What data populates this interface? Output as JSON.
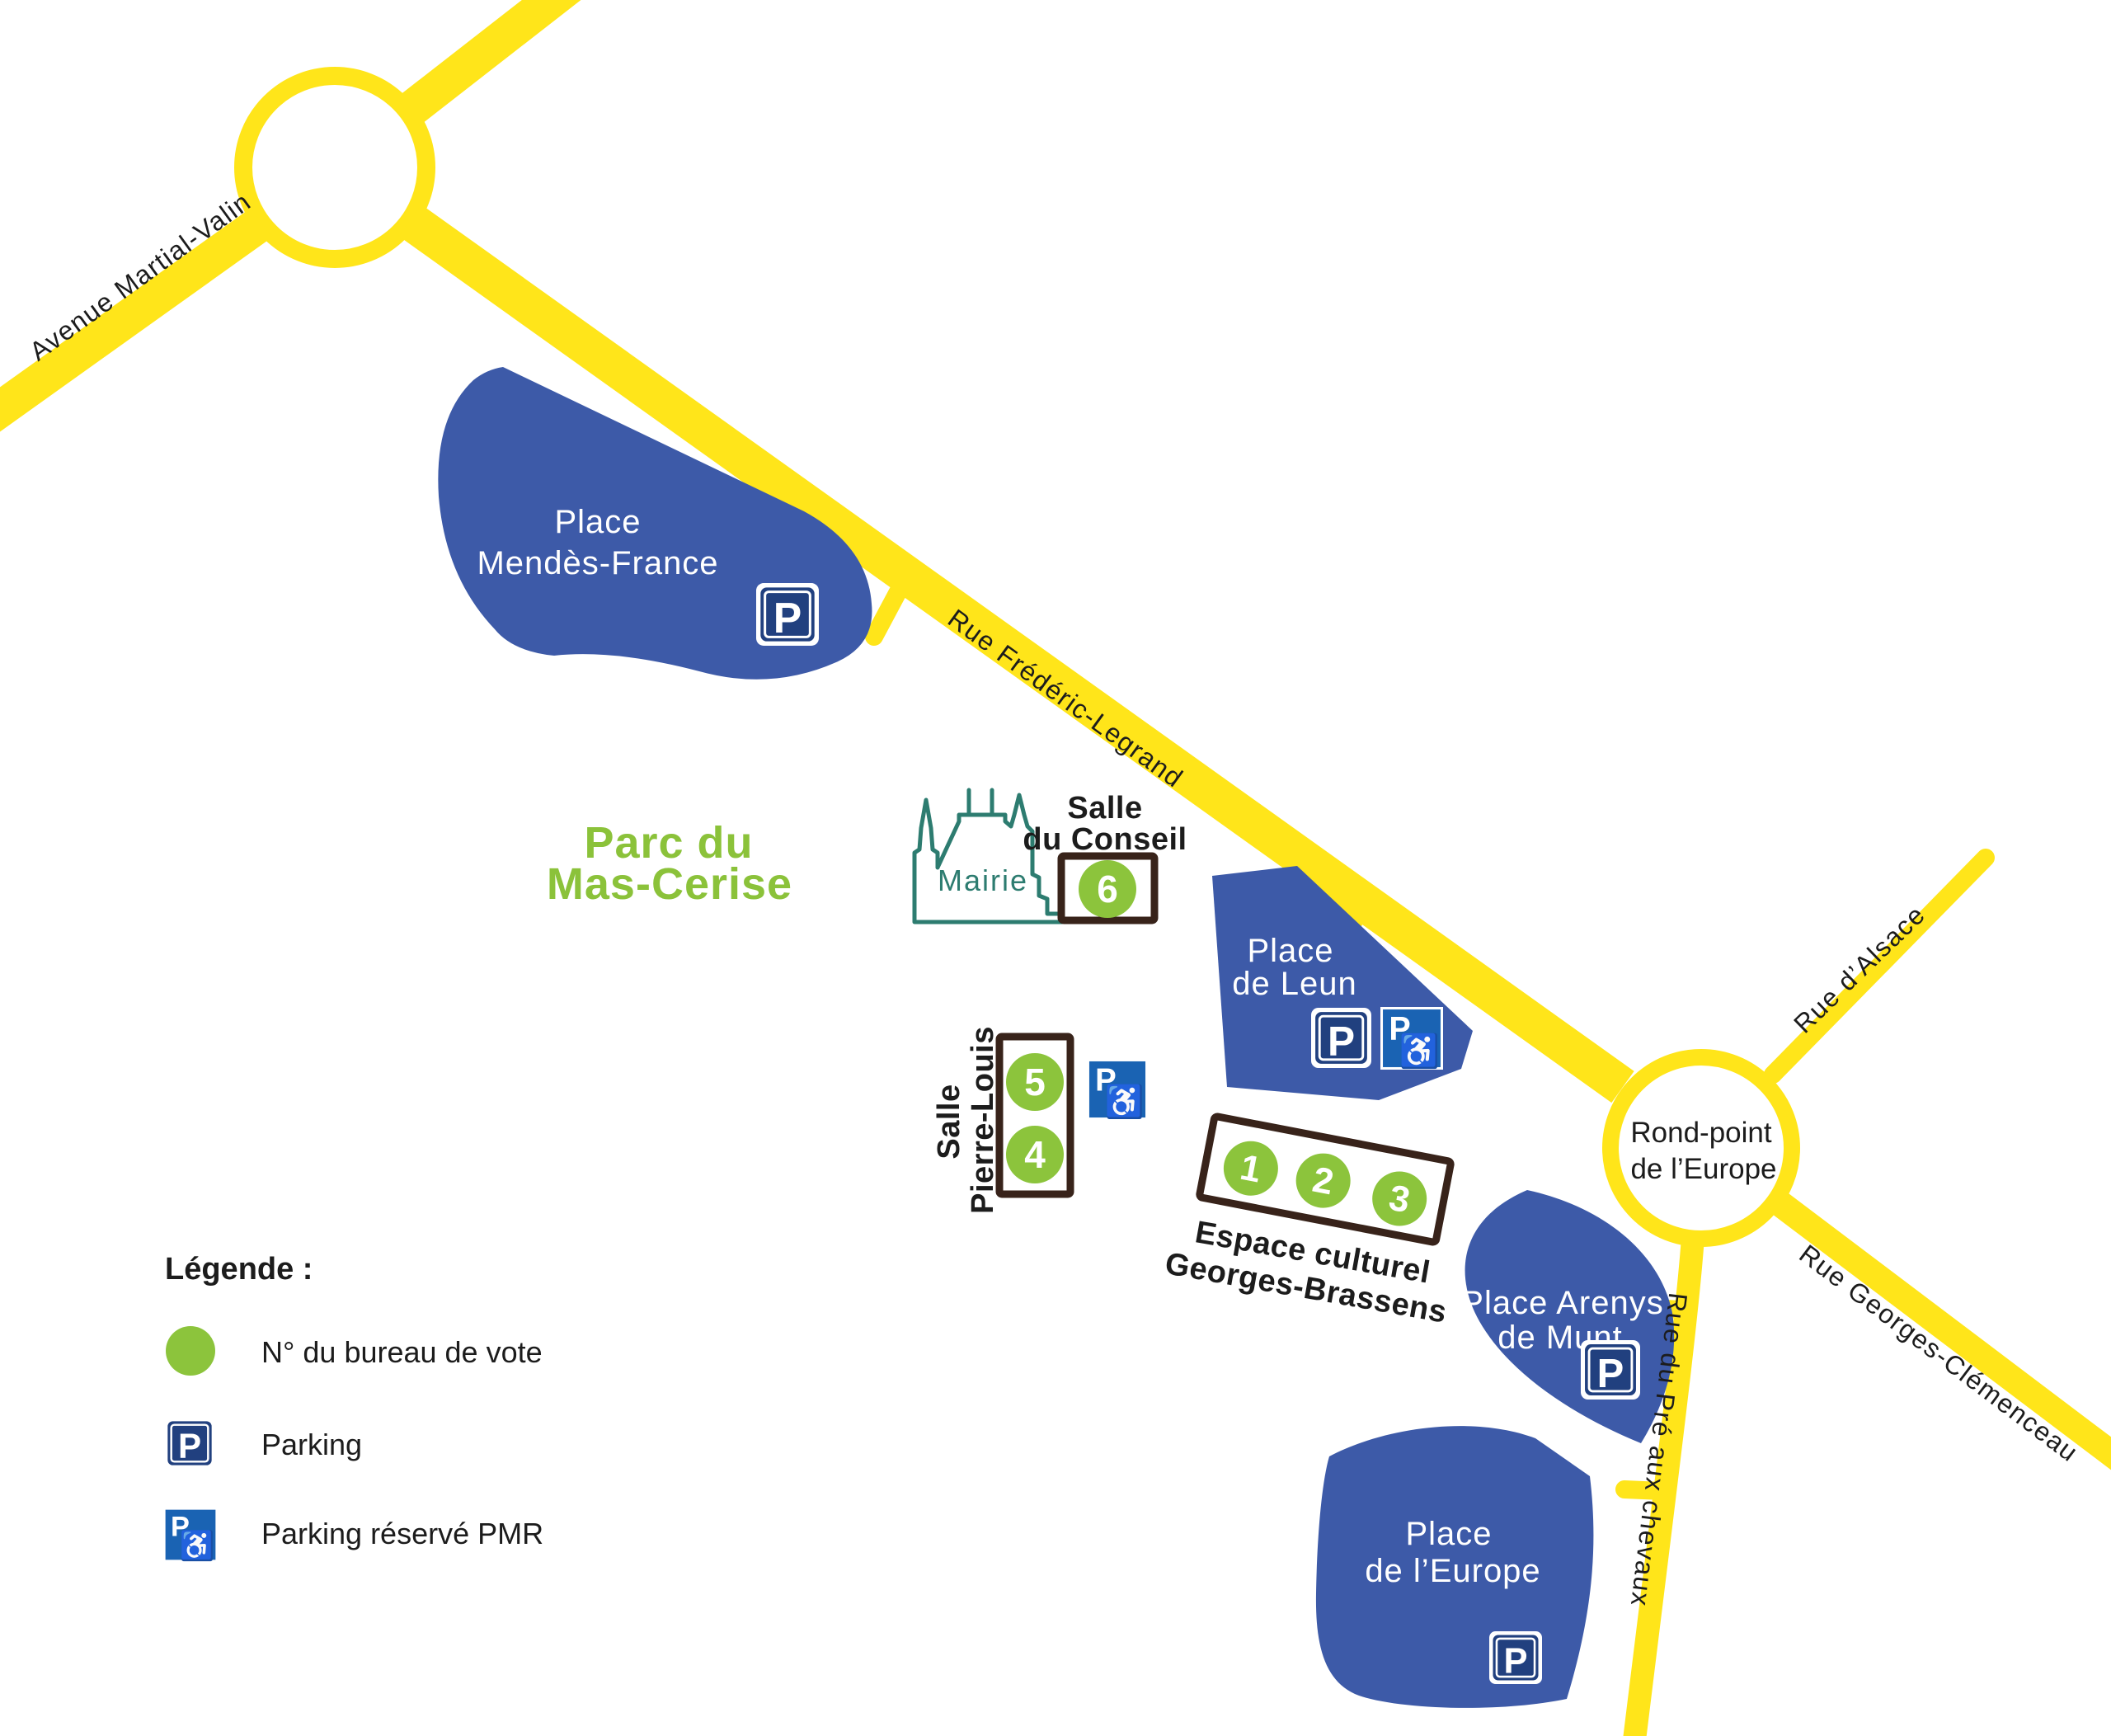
{
  "colors": {
    "road": "#ffe51a",
    "place": "#3d5aa8",
    "place_text": "#ffffff",
    "bureau": "#8cc43c",
    "parc_green": "#8bc23a",
    "mairie": "#2d7c70",
    "box": "#38231a",
    "ink": "#1c1c1c",
    "parking": "#21407f",
    "pmr": "#1a63b3"
  },
  "parking_letter": "P",
  "icons": {
    "wheelchair": "♿"
  },
  "roads": {
    "avenue_martial_valin": "Avenue Martial-Valin",
    "rue_frederic_legrand": "Rue Frédéric-Legrand",
    "rue_d_alsace": "Rue d’Alsace",
    "rue_georges_clemenceau": "Rue Georges-Clémenceau",
    "rue_du_pre_aux_chevaux": "Rue du Pré aux chevaux",
    "rond_point": {
      "lines": [
        "Rond-point",
        "de l’Europe"
      ]
    }
  },
  "park": {
    "lines": [
      "Parc du",
      "Mas-Cerise"
    ]
  },
  "mairie": {
    "label": "Mairie"
  },
  "places": {
    "mendes_france": {
      "lines": [
        "Place",
        "Mendès-France"
      ]
    },
    "leun": {
      "lines": [
        "Place",
        "de Leun"
      ]
    },
    "arenys": {
      "lines": [
        "Place Arenys",
        "de Munt"
      ]
    },
    "europe": {
      "lines": [
        "Place",
        "de l’Europe"
      ]
    }
  },
  "polling_sites": {
    "salle_du_conseil": {
      "name_lines": [
        "Salle",
        "du Conseil"
      ],
      "bureaus": [
        "6"
      ]
    },
    "salle_pierre_louis": {
      "name_lines": [
        "Salle",
        "Pierre-Louis"
      ],
      "bureaus": [
        "5",
        "4"
      ]
    },
    "espace_culturel": {
      "name_lines": [
        "Espace culturel",
        "Georges-Brassens"
      ],
      "bureaus": [
        "1",
        "2",
        "3"
      ]
    }
  },
  "legend": {
    "title": "Légende :",
    "items": [
      {
        "icon": "bureau-circle-icon",
        "label": "N° du bureau de vote"
      },
      {
        "icon": "parking-icon",
        "label": "Parking"
      },
      {
        "icon": "pmr-parking-icon",
        "label": "Parking réservé PMR"
      }
    ]
  }
}
